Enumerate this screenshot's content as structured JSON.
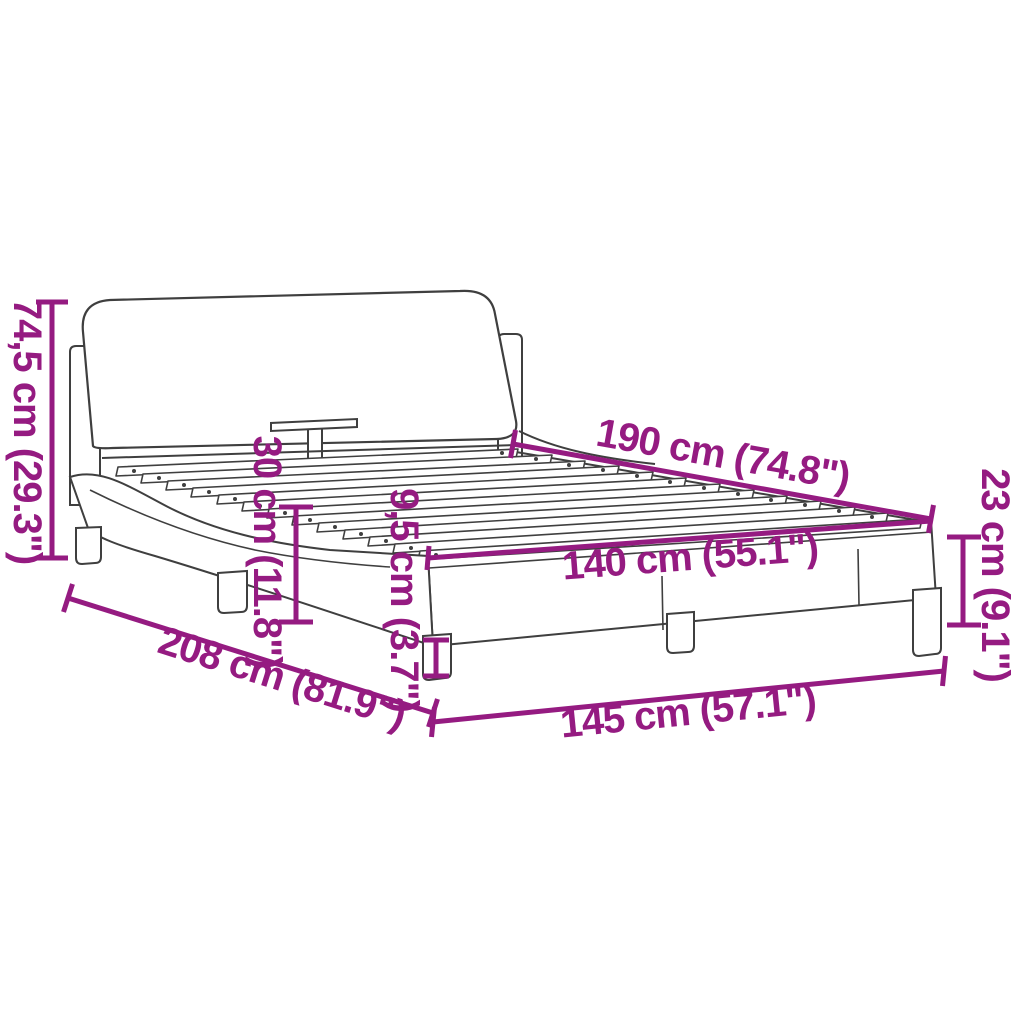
{
  "diagram": {
    "kind": "product-dimension-diagram",
    "subject": "bed-frame-with-headboard-and-slats",
    "accent_color": "#951b81",
    "outline_color": "#3f3f3f",
    "background_color": "#ffffff",
    "dimensions": [
      {
        "name": "overall-height",
        "label": "74,5 cm (29.3\")"
      },
      {
        "name": "base-height",
        "label": "30 cm (11.8\")"
      },
      {
        "name": "leg-height",
        "label": "9,5 cm (3.7\")"
      },
      {
        "name": "inner-length",
        "label": "190 cm (74.8\")"
      },
      {
        "name": "inner-width",
        "label": "140 cm (55.1\")"
      },
      {
        "name": "footboard-height",
        "label": "23 cm (9.1\")"
      },
      {
        "name": "overall-length",
        "label": "208 cm (81.9\")"
      },
      {
        "name": "overall-width",
        "label": "145 cm (57.1\")"
      }
    ]
  }
}
